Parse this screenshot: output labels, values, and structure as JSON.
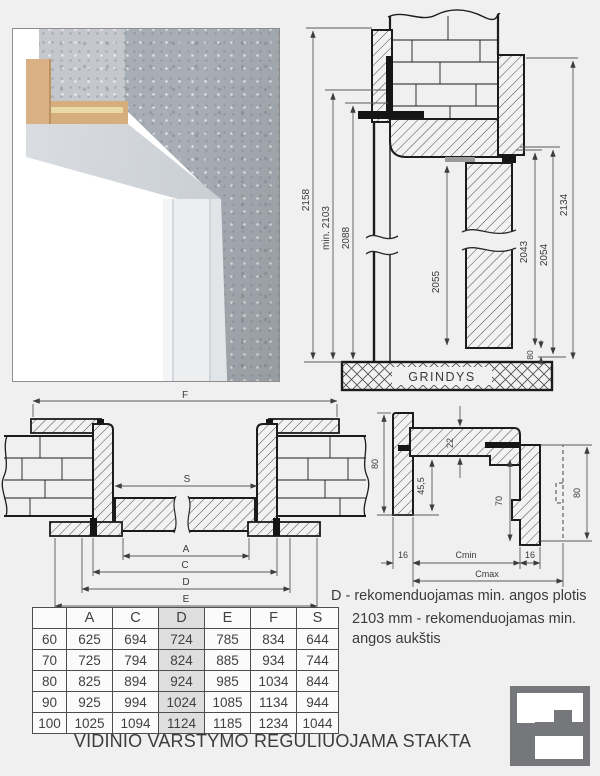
{
  "colors": {
    "background": "#f0f0f1",
    "drawing_line": "#1c1c1c",
    "dimension_line": "#5a5a5a",
    "text": "#3b3b3b",
    "table_border": "#4d4d4d",
    "table_highlight": "#dededf",
    "logo_gray": "#76777a",
    "photo_concrete": "#a8aeb5",
    "photo_wood": "#d9b184",
    "photo_frame_white": "#eceef0"
  },
  "vertical_section": {
    "floor_label": "GRINDYS",
    "dims": {
      "d2158": "2158",
      "d2103": "min. 2103",
      "d2088": "2088",
      "d2055": "2055",
      "d2043": "2043",
      "d2054": "2054",
      "d2134": "2134",
      "d80": "80"
    }
  },
  "horizontal_section": {
    "dims": {
      "f": "F",
      "s": "S",
      "a": "A",
      "c": "C",
      "d": "D",
      "e": "E"
    }
  },
  "detail_section": {
    "dims": {
      "w80_left": "80",
      "t22": "22",
      "h455": "45,5",
      "h70": "70",
      "w80_right": "80",
      "t16_left": "16",
      "cmin": "Cmin",
      "t16_right": "16",
      "cmax": "Cmax"
    }
  },
  "notes": {
    "width_note": "D - rekomenduojamas min. angos plotis",
    "height_note_line1": "2103 mm - rekomenduojamas min.",
    "height_note_line2": "angos aukštis"
  },
  "size_table": {
    "headers": [
      "",
      "A",
      "C",
      "D",
      "E",
      "F",
      "S"
    ],
    "highlighted_column": "D",
    "rows": [
      [
        "60",
        "625",
        "694",
        "724",
        "785",
        "834",
        "644"
      ],
      [
        "70",
        "725",
        "794",
        "824",
        "885",
        "934",
        "744"
      ],
      [
        "80",
        "825",
        "894",
        "924",
        "985",
        "1034",
        "844"
      ],
      [
        "90",
        "925",
        "994",
        "1024",
        "1085",
        "1134",
        "944"
      ],
      [
        "100",
        "1025",
        "1094",
        "1124",
        "1185",
        "1234",
        "1044"
      ]
    ]
  },
  "footer_title": "VIDINIO VARSTYMO REGULIUOJAMA STAKTA"
}
